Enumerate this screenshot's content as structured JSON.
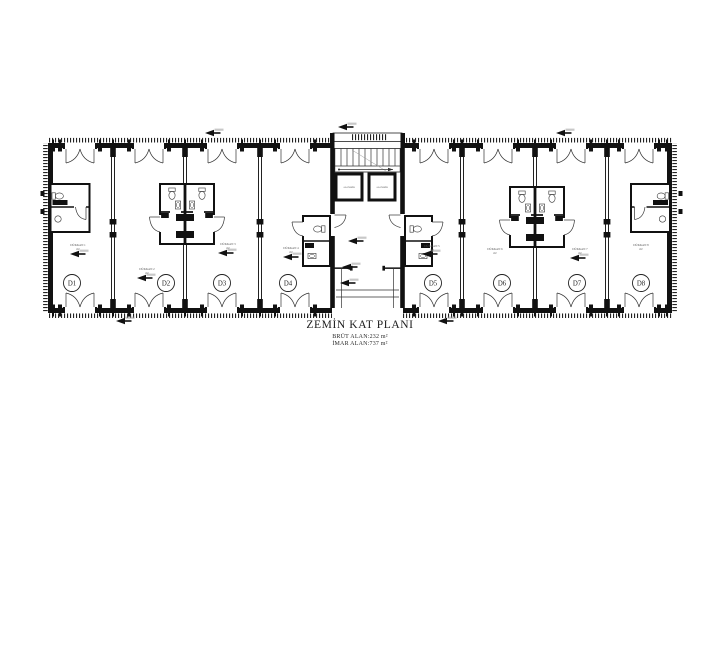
{
  "plan": {
    "title": "ZEMİN KAT PLANI",
    "brut_area": "BRÜT ALAN:232 m²",
    "imar_area": "İMAR ALAN:737 m²",
    "units": [
      {
        "id": "D1",
        "room": "DÜKKAN 1",
        "area_note": "m²"
      },
      {
        "id": "D2",
        "room": "DÜKKAN 2",
        "area_note": "m²"
      },
      {
        "id": "D3",
        "room": "DÜKKAN 3",
        "area_note": "m²"
      },
      {
        "id": "D4",
        "room": "DÜKKAN 4",
        "area_note": "m²"
      },
      {
        "id": "D5",
        "room": "DÜKKAN 5",
        "area_note": "m²"
      },
      {
        "id": "D6",
        "room": "DÜKKAN 6",
        "area_note": "m²"
      },
      {
        "id": "D7",
        "room": "DÜKKAN 7",
        "area_note": "m²"
      },
      {
        "id": "D8",
        "room": "DÜKKAN 8",
        "area_note": "m²"
      }
    ],
    "core": {
      "elevator1": "ASANSÖR",
      "elevator2": "ASANSÖR"
    },
    "colors": {
      "line": "#1c1c1c",
      "wall": "#111111",
      "background": "#ffffff"
    }
  }
}
